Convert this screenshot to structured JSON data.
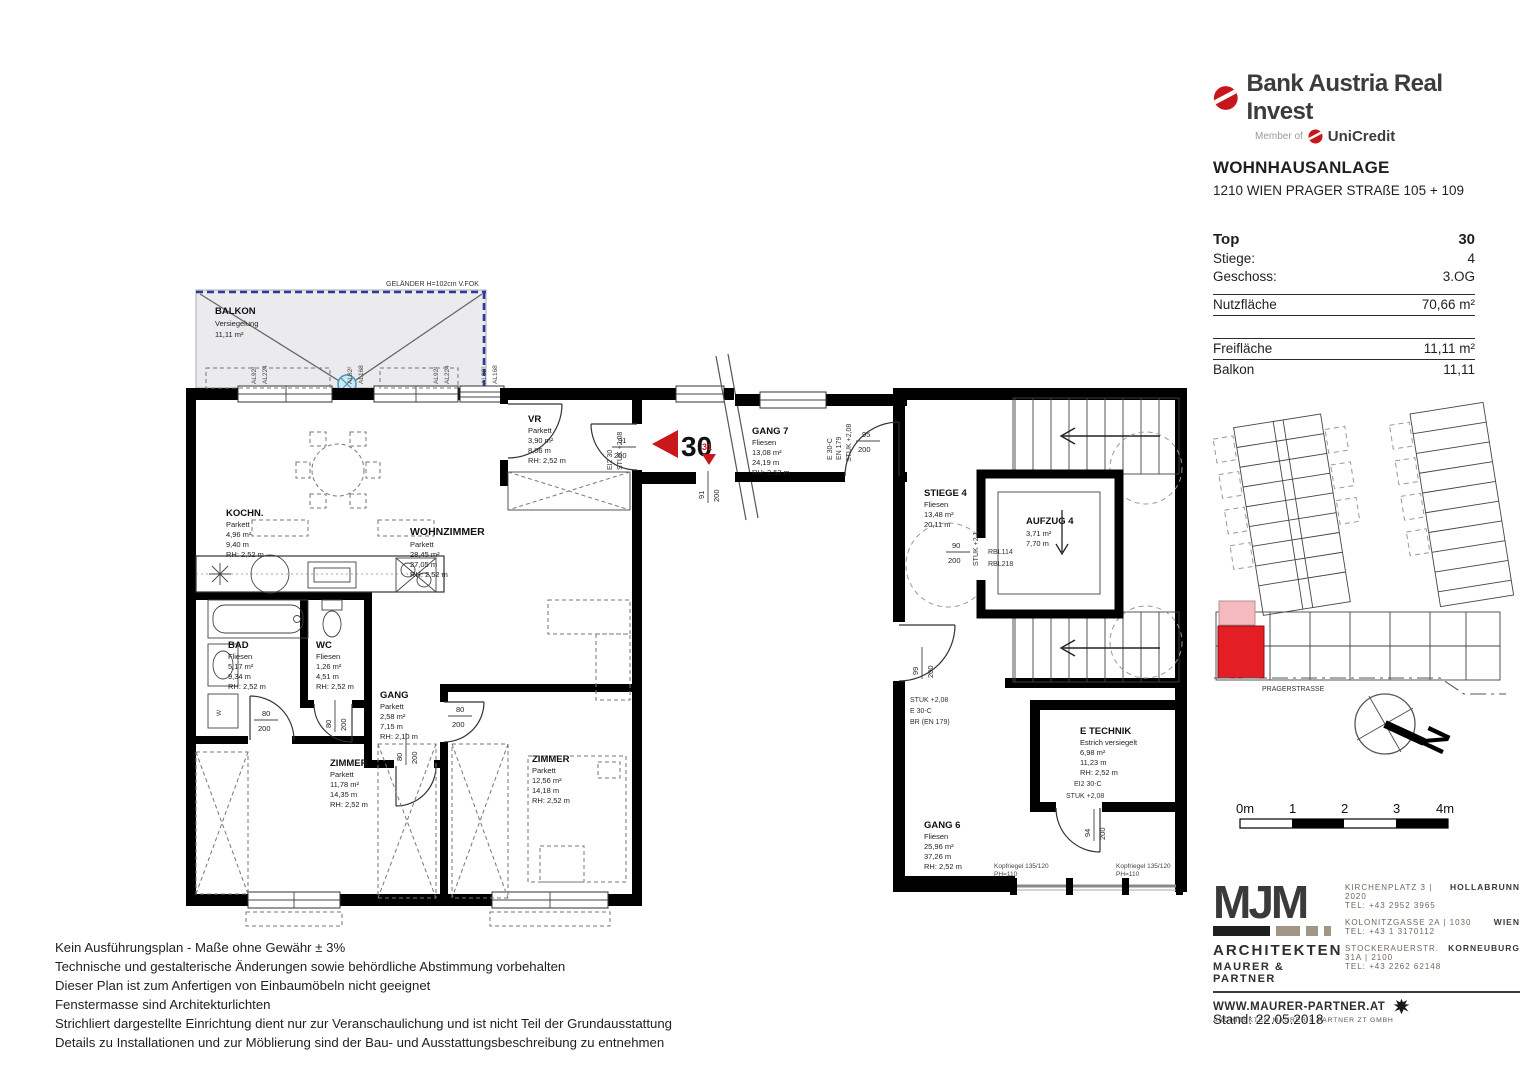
{
  "brand": {
    "name": "Bank Austria Real Invest",
    "member_prefix": "Member of",
    "member_name": "UniCredit"
  },
  "project": {
    "title": "WOHNHAUSANLAGE",
    "address": "1210 WIEN PRAGER STRAßE 105 + 109"
  },
  "unit": {
    "top_label": "Top",
    "top_value": "30",
    "stiege_label": "Stiege:",
    "stiege_value": "4",
    "geschoss_label": "Geschoss:",
    "geschoss_value": "3.OG",
    "nutzflaeche_label": "Nutzfläche",
    "nutzflaeche_value": "70,66 m²",
    "freiflaeche_label": "Freifläche",
    "freiflaeche_value": "11,11 m²",
    "balkon_label": "Balkon",
    "balkon_value": "11,11"
  },
  "rooms": {
    "balkon": {
      "name": "BALKON",
      "l1": "Versiegelung",
      "l2": "11,11 m²"
    },
    "vr": {
      "name": "VR",
      "l1": "Parkett",
      "l2": "3,90 m²",
      "l3": "8,06 m",
      "l4": "RH: 2,52 m"
    },
    "kochn": {
      "name": "KOCHN.",
      "l1": "Parkett",
      "l2": "4,96 m²",
      "l3": "9,40 m",
      "l4": "RH: 2,52 m"
    },
    "wohnzimmer": {
      "name": "WOHNZIMMER",
      "l1": "Parkett",
      "l2": "28,45 m²",
      "l3": "27,05 m",
      "l4": "RH: 2,52 m"
    },
    "bad": {
      "name": "BAD",
      "l1": "Fliesen",
      "l2": "5,17 m²",
      "l3": "9,34 m",
      "l4": "RH: 2,52 m"
    },
    "wc": {
      "name": "WC",
      "l1": "Fliesen",
      "l2": "1,26 m²",
      "l3": "4,51 m",
      "l4": "RH: 2,52 m"
    },
    "gang": {
      "name": "GANG",
      "l1": "Parkett",
      "l2": "2,58 m²",
      "l3": "7,15 m",
      "l4": "RH: 2,10 m"
    },
    "zimmer1": {
      "name": "ZIMMER",
      "l1": "Parkett",
      "l2": "11,78 m²",
      "l3": "14,35 m",
      "l4": "RH: 2,52 m"
    },
    "zimmer2": {
      "name": "ZIMMER",
      "l1": "Parkett",
      "l2": "12,56 m²",
      "l3": "14,18 m",
      "l4": "RH: 2,52 m"
    },
    "gang7": {
      "name": "GANG 7",
      "l1": "Fliesen",
      "l2": "13,08 m²",
      "l3": "24,19 m",
      "l4": "RH: 2,52 m"
    },
    "stiege4": {
      "name": "STIEGE 4",
      "l1": "Fliesen",
      "l2": "13,48 m²",
      "l3": "20,11 m"
    },
    "aufzug4": {
      "name": "AUFZUG 4",
      "l1": "3,71 m²",
      "l2": "7,70 m"
    },
    "etechnik": {
      "name": "E TECHNIK",
      "l1": "Estrich versiegelt",
      "l2": "6,98 m²",
      "l3": "11,23 m",
      "l4": "RH: 2,52 m"
    },
    "gang6": {
      "name": "GANG 6",
      "l1": "Fliesen",
      "l2": "25,96 m²",
      "l3": "37,26 m",
      "l4": "RH: 2,52 m"
    }
  },
  "labels": {
    "gelaender": "GELÄNDER H=102cm V.FOK",
    "unit_arrow": "30",
    "door31": "31",
    "ei2_30": "EI2 30",
    "stuk_208": "STUK +2,08",
    "e30c": "E 30-C",
    "en179": "EN 179",
    "br_en179": "BR (EN 179)",
    "ei2_30c": "EI2 30-C",
    "stuk_21": "STUK +2,1",
    "rbl114": "RBL114",
    "rbl218": "RBL218",
    "kopfriegel": "Kopfriegel 135/120",
    "ph": "PH=110",
    "al92": "AL92²",
    "al224": "AL224",
    "al82": "AL82²",
    "al168": "AL168",
    "w": "W"
  },
  "dims": {
    "n80": "80",
    "n90": "90",
    "n91": "91",
    "n94": "94",
    "n95": "95",
    "n99": "99",
    "d200": "200"
  },
  "site": {
    "street": "PRAGERSTRASSE"
  },
  "compass": {
    "north": "N"
  },
  "scale_bar": {
    "t0": "0m",
    "t1": "1",
    "t2": "2",
    "t3": "3",
    "t4": "4m"
  },
  "disclaimer": {
    "lines": [
      "Kein Ausführungsplan - Maße ohne Gewähr ± 3%",
      "Technische und gestalterische Änderungen sowie behördliche Abstimmung vorbehalten",
      "Dieser Plan ist zum Anfertigen von Einbaumöbeln nicht geeignet",
      "Fenstermasse sind Architekturlichten",
      "Strichliert dargestellte Einrichtung dient nur zur Veranschaulichung und ist nicht Teil der Grundausstattung",
      "Details zu Installationen und zur Möblierung sind der Bau- und Ausstattungsbeschreibung zu entnehmen"
    ]
  },
  "architects": {
    "logo": "MJM",
    "line1": "ARCHITEKTEN",
    "line2": "MAURER & PARTNER",
    "offices": [
      {
        "address": "KIRCHENPLATZ 3  |  2020",
        "city": "HOLLABRUNN",
        "tel": "TEL: +43 2952 3965"
      },
      {
        "address": "KOLONITZGASSE 2A  |  1030",
        "city": "WIEN",
        "tel": "TEL: +43 1 3170112"
      },
      {
        "address": "STOCKERAUERSTR. 31A  |  2100",
        "city": "KORNEUBURG",
        "tel": "TEL: +43 2262 62148"
      }
    ],
    "website": "WWW.MAURER-PARTNER.AT",
    "company": "ARCHITEKTEN MAURER & PARTNER ZT GMBH"
  },
  "stand": "Stand: 22.05.2018"
}
